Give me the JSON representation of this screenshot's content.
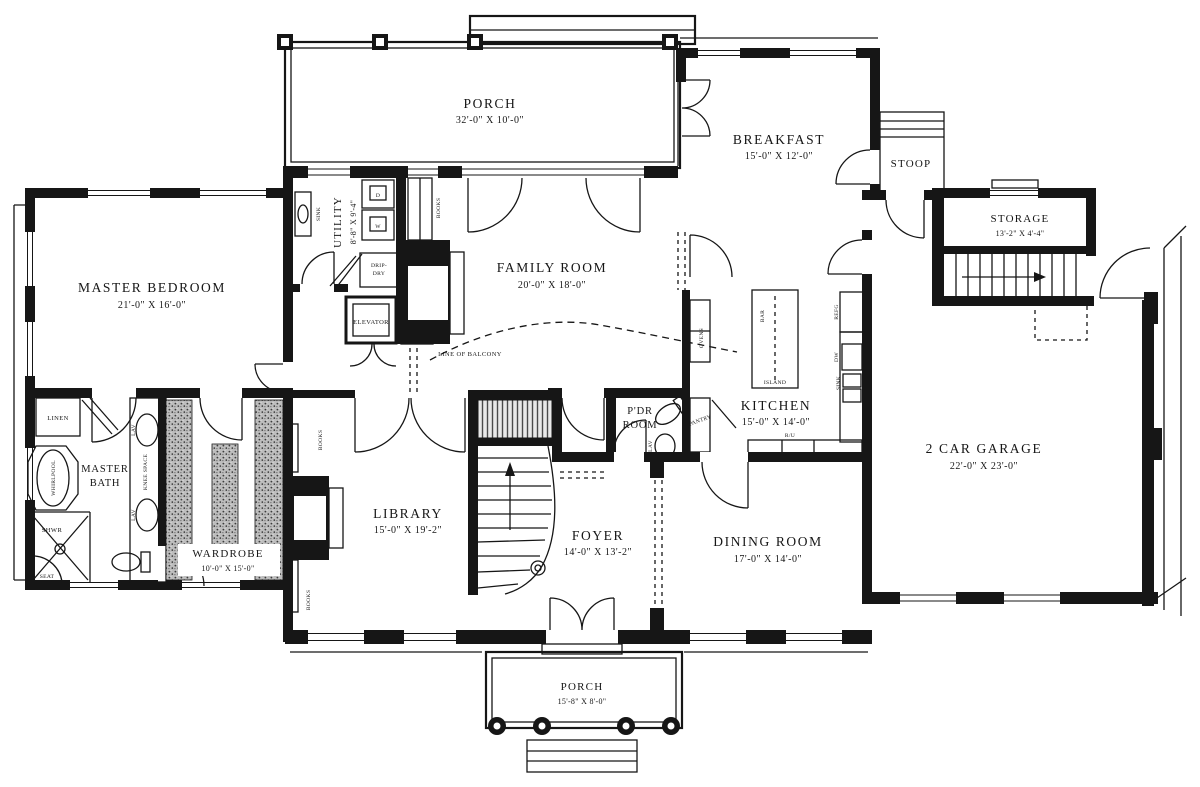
{
  "colors": {
    "ink": "#161616",
    "paper": "#ffffff"
  },
  "rooms": {
    "porch_top": {
      "name": "PORCH",
      "dims": "32'-0\" X 10'-0\""
    },
    "breakfast": {
      "name": "BREAKFAST",
      "dims": "15'-0\" X 12'-0\""
    },
    "stoop": {
      "name": "STOOP"
    },
    "storage": {
      "name": "STORAGE",
      "dims": "13'-2\" X 4'-4\""
    },
    "garage": {
      "name": "2 CAR GARAGE",
      "dims": "22'-0\" X 23'-0\""
    },
    "master_bedroom": {
      "name": "MASTER BEDROOM",
      "dims": "21'-0\" X 16'-0\""
    },
    "master_bath": {
      "line1": "MASTER",
      "line2": "BATH"
    },
    "wardrobe": {
      "name": "WARDROBE",
      "dims": "10'-0\" X 15'-0\""
    },
    "utility": {
      "name": "UTILITY",
      "dims": "8'-8\" X 9'-4\""
    },
    "family_room": {
      "name": "FAMILY ROOM",
      "dims": "20'-0\" X 18'-0\""
    },
    "kitchen": {
      "name": "KITCHEN",
      "dims": "15'-0\" X 14'-0\""
    },
    "pdr_room": {
      "line1": "P'DR",
      "line2": "ROOM"
    },
    "library": {
      "name": "LIBRARY",
      "dims": "15'-0\" X 19'-2\""
    },
    "foyer": {
      "name": "FOYER",
      "dims": "14'-0\" X 13'-2\""
    },
    "dining_room": {
      "name": "DINING ROOM",
      "dims": "17'-0\" X 14'-0\""
    },
    "porch_bottom": {
      "name": "PORCH",
      "dims": "15'-8\" X 8'-0\""
    }
  },
  "fixtures": {
    "linen": "LINEN",
    "elevator": "ELEVATOR",
    "drip_dry_line1": "DRIP-",
    "drip_dry_line2": "DRY",
    "books": "BOOKS",
    "sink": "SINK",
    "washer": "W",
    "dryer": "D",
    "line_of_balcony": "LINE OF BALCONY",
    "whirlpool": "WHIRLPOOL",
    "shower": "SHWR",
    "seat": "SEAT",
    "lav": "LAV",
    "knee_space": "KNEE SPACE",
    "bar": "BAR",
    "island": "ISLAND",
    "refrigerator": "REFG",
    "dishwasher": "DW",
    "range_unit": "R/U",
    "ovens": "OVENS",
    "pantry": "PANTRY"
  }
}
